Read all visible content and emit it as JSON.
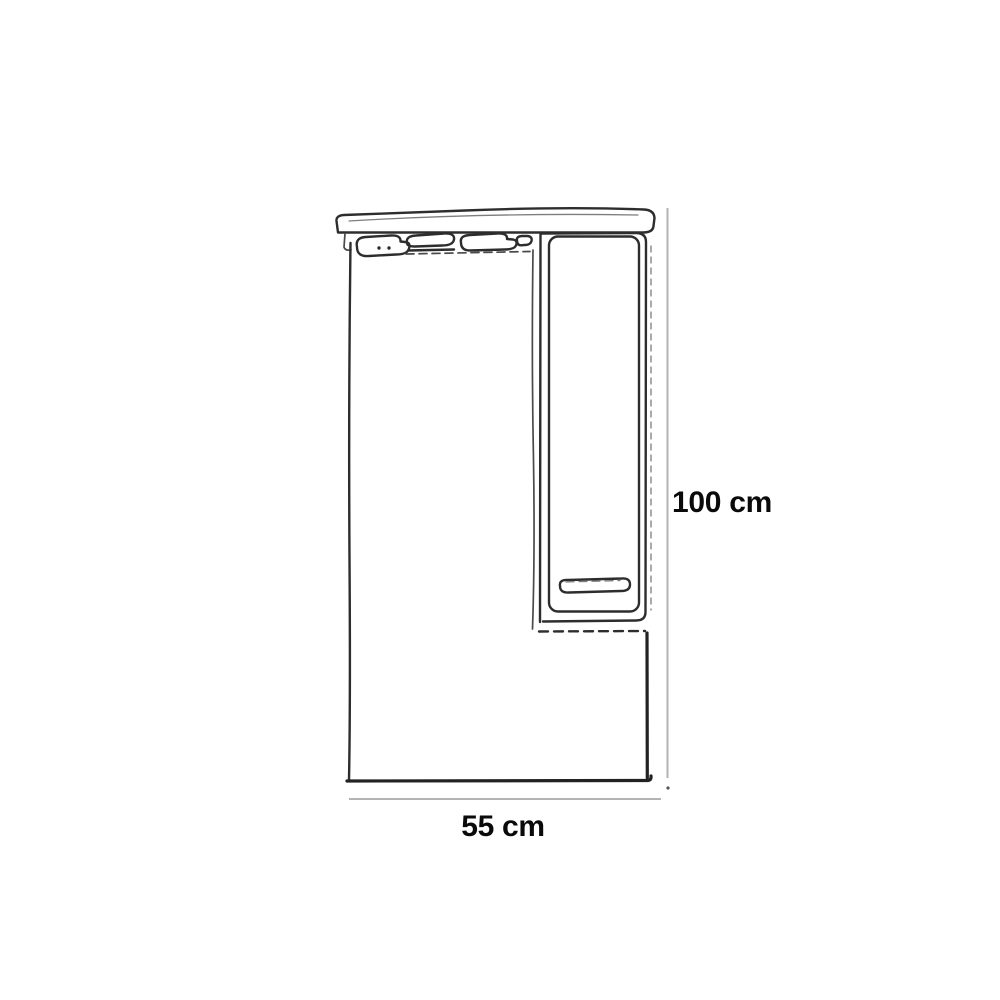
{
  "page": {
    "background_color": "#ffffff"
  },
  "drawing": {
    "kind": "technical-line-drawing",
    "stroke_color": "#2d2d2d",
    "secondary_stroke_color": "#4a4a4a",
    "hidden_line_color": "#7d7d7d",
    "dimension_line_color": "#b3b3b3",
    "label_color": "#0a0a0a",
    "parts": [
      "top-canopy",
      "light-fixture-strip",
      "mirror-panel",
      "side-cabinet",
      "cabinet-door",
      "door-handle",
      "height-dimension-line",
      "width-dimension-line"
    ],
    "dimensions": {
      "height_label": "100 cm",
      "width_label": "55 cm"
    }
  }
}
